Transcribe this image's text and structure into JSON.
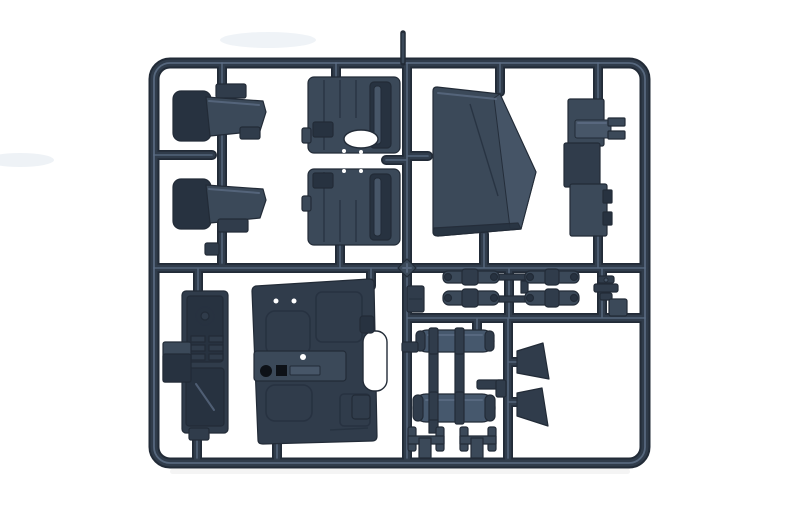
{
  "scene": {
    "description": "Photograph of a dark blue-gray injection-molded plastic model kit sprue on a white background, containing truck cab parts",
    "background_color": "#ffffff"
  },
  "colors": {
    "background": "#ffffff",
    "edge": "#222b37",
    "plastic_darkest": "#273240",
    "plastic_dark": "#303c4b",
    "plastic_mid": "#3b4959",
    "plastic_light": "#475668",
    "plastic_highlight": "#5d6e86",
    "tank": "#46586d",
    "black_detail": "#0d1117",
    "hole_white": "#ffffff",
    "smudge": "#e7edf2",
    "shadow": "#e7e7e7"
  },
  "parts": [
    {
      "name": "sprue-frame",
      "label": "rounded rectangular sprue frame with internal runners",
      "qty": 1
    },
    {
      "name": "sprue-gate",
      "label": "feed gate tab on top edge",
      "qty": 1
    },
    {
      "name": "seat",
      "label": "cab seat, side profile",
      "qty": 2
    },
    {
      "name": "door-card",
      "label": "door interior panel with oval cutout and window channel",
      "qty": 2
    },
    {
      "name": "windscreen-panel",
      "label": "large five-sided windscreen/roof panel",
      "qty": 1
    },
    {
      "name": "stepped-bracket",
      "label": "stepped vertical bracket with forked tab",
      "qty": 1
    },
    {
      "name": "dashboard",
      "label": "instrument panel with dial and switch details",
      "qty": 1
    },
    {
      "name": "cab-floor",
      "label": "large cab floor panel with console, knob and recesses",
      "qty": 1
    },
    {
      "name": "leaf-spring",
      "label": "leaf spring bar",
      "qty": 4
    },
    {
      "name": "air-tank",
      "label": "cylindrical air tank with mounting straps",
      "qty": 2
    },
    {
      "name": "mud-flap",
      "label": "trapezoidal mud flap",
      "qty": 2
    },
    {
      "name": "h-bracket",
      "label": "H-shaped mounting bracket",
      "qty": 2
    },
    {
      "name": "valve-fitting",
      "label": "small valve/fitting part",
      "qty": 1
    },
    {
      "name": "junction-boss",
      "label": "diamond boss at runner crossing",
      "qty": 1
    }
  ]
}
